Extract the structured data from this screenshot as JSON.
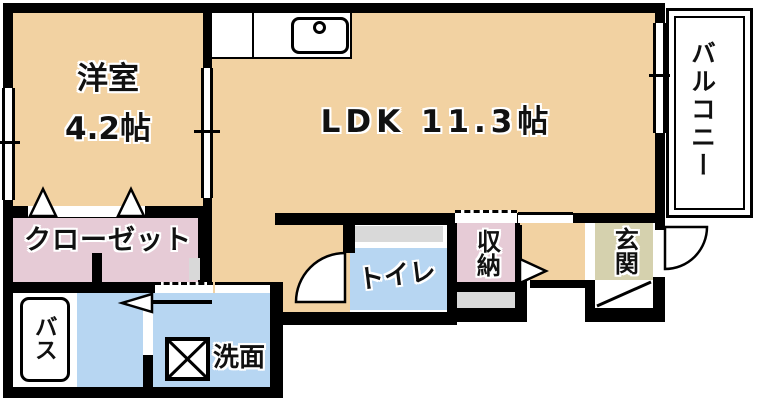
{
  "rooms": {
    "western": {
      "name": "洋室",
      "area": "4.2帖"
    },
    "ldk": {
      "name": "LDK 11.3帖"
    },
    "balcony": {
      "name": "バルコニー"
    },
    "closet": {
      "name": "クローゼット"
    },
    "bath": {
      "name": "バス"
    },
    "washroom": {
      "name": "洗面"
    },
    "toilet": {
      "name": "トイレ"
    },
    "storage": {
      "name": "収納"
    },
    "entrance": {
      "name": "玄関"
    }
  },
  "colors": {
    "floor": "#f2d2a2",
    "pink": "#e6cbd6",
    "blue": "#b7d6f2",
    "olive": "#d5d1ae",
    "gray": "#d9d9d9",
    "wall": "#000000"
  }
}
